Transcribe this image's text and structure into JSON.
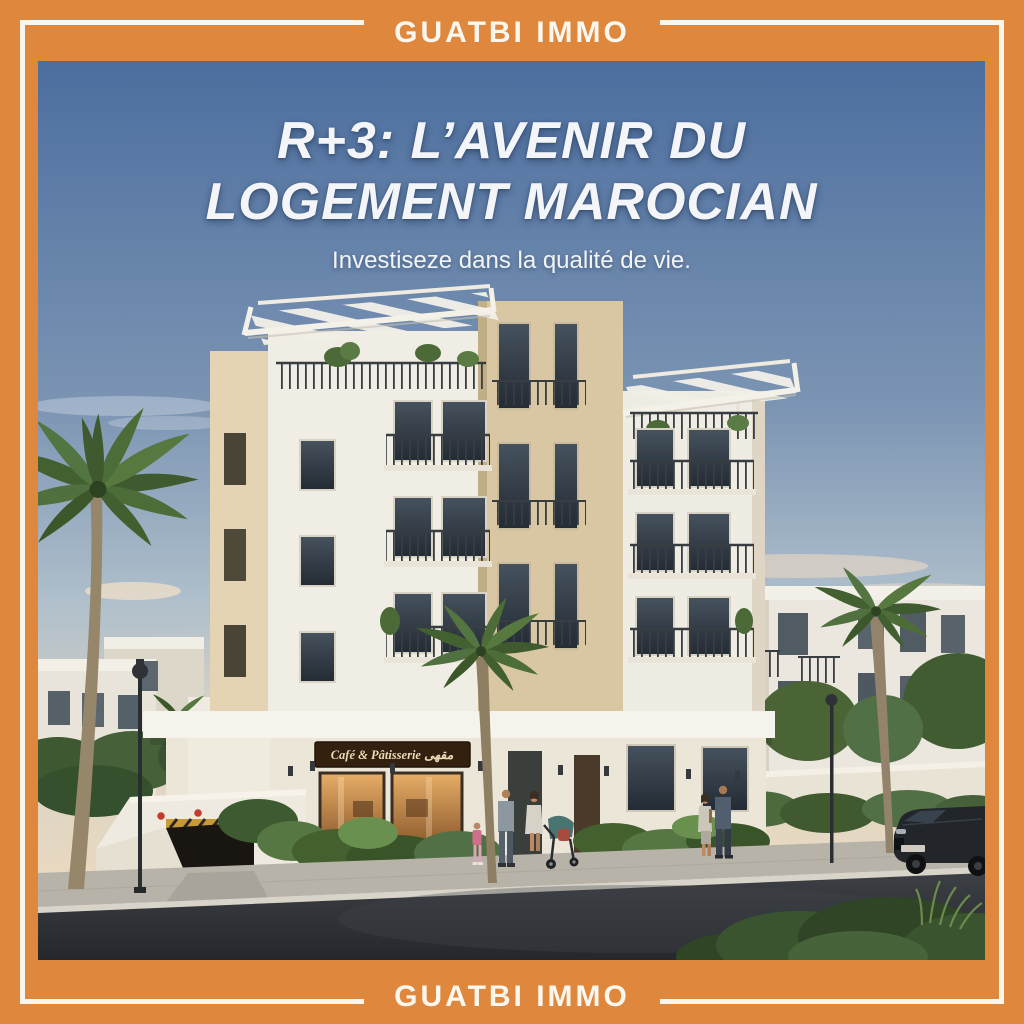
{
  "brand": {
    "top_label": "GUATBI IMMO",
    "bottom_label": "GUATBI IMMO"
  },
  "hero": {
    "headline_line1": "R+3: L’AVENIR DU",
    "headline_line2": "LOGEMENT MAROCIAN",
    "subtitle": "Investiseze dans la qualité de vie."
  },
  "scene": {
    "cafe_sign_text": "Café & Pâtisserie  مقهى",
    "subject": "R+3 residential building render with palm trees, café, street and pedestrians"
  },
  "colors": {
    "frame_orange": "#E0873E",
    "frame_inner_line": "#F8F5EC",
    "headline_white": "#F3F5F9",
    "sky_top_blue": "#4C6E9F",
    "sky_horizon_warm": "#EDDCC2",
    "building_cream": "#F0EDE5",
    "building_beige": "#D9C7A3",
    "cafe_sign_brown": "#33200F",
    "asphalt_dark": "#25282C"
  }
}
